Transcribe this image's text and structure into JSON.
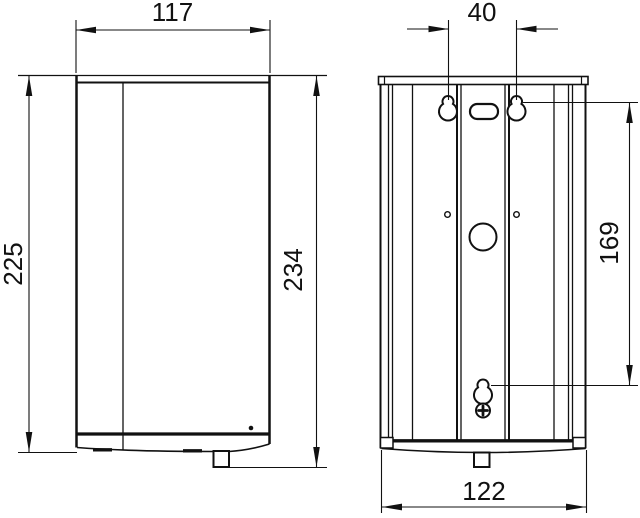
{
  "front_view": {
    "width_mm": "117",
    "height_body_mm": "225",
    "height_total_mm": "234"
  },
  "back_view": {
    "mount_hole_spacing_mm": "40",
    "mount_hole_vertical_mm": "169",
    "width_mm": "122"
  },
  "colors": {
    "line": "#111111",
    "background": "#ffffff"
  }
}
